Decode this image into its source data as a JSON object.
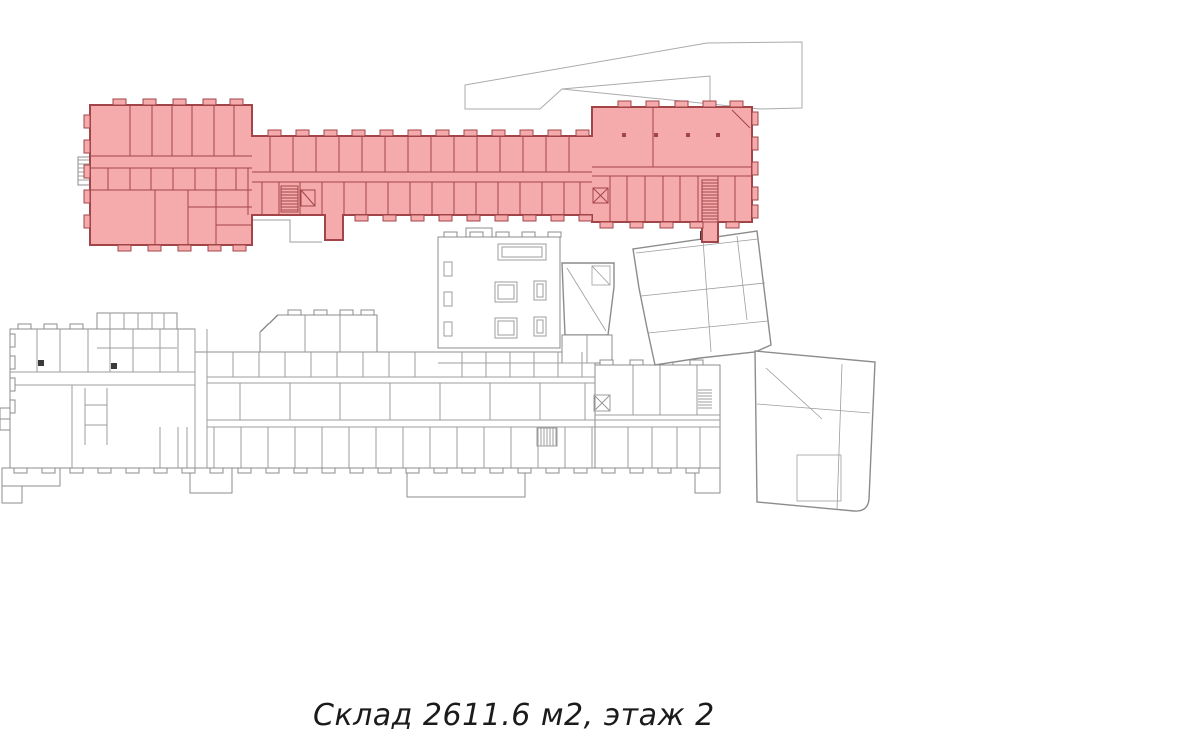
{
  "caption": {
    "text": "Склад 2611.6 м2, этаж 2",
    "object_type": "Склад",
    "area_m2": "2611.6",
    "floor": "2"
  },
  "colors": {
    "background": "#ffffff",
    "highlight_fill": "#f5abab",
    "highlight_wall": "#a24549",
    "building_outline": "#8c8c8c",
    "room_line": "#9d9d9d",
    "site_outline": "#ababab",
    "caption_text": "#1b1b1b"
  }
}
